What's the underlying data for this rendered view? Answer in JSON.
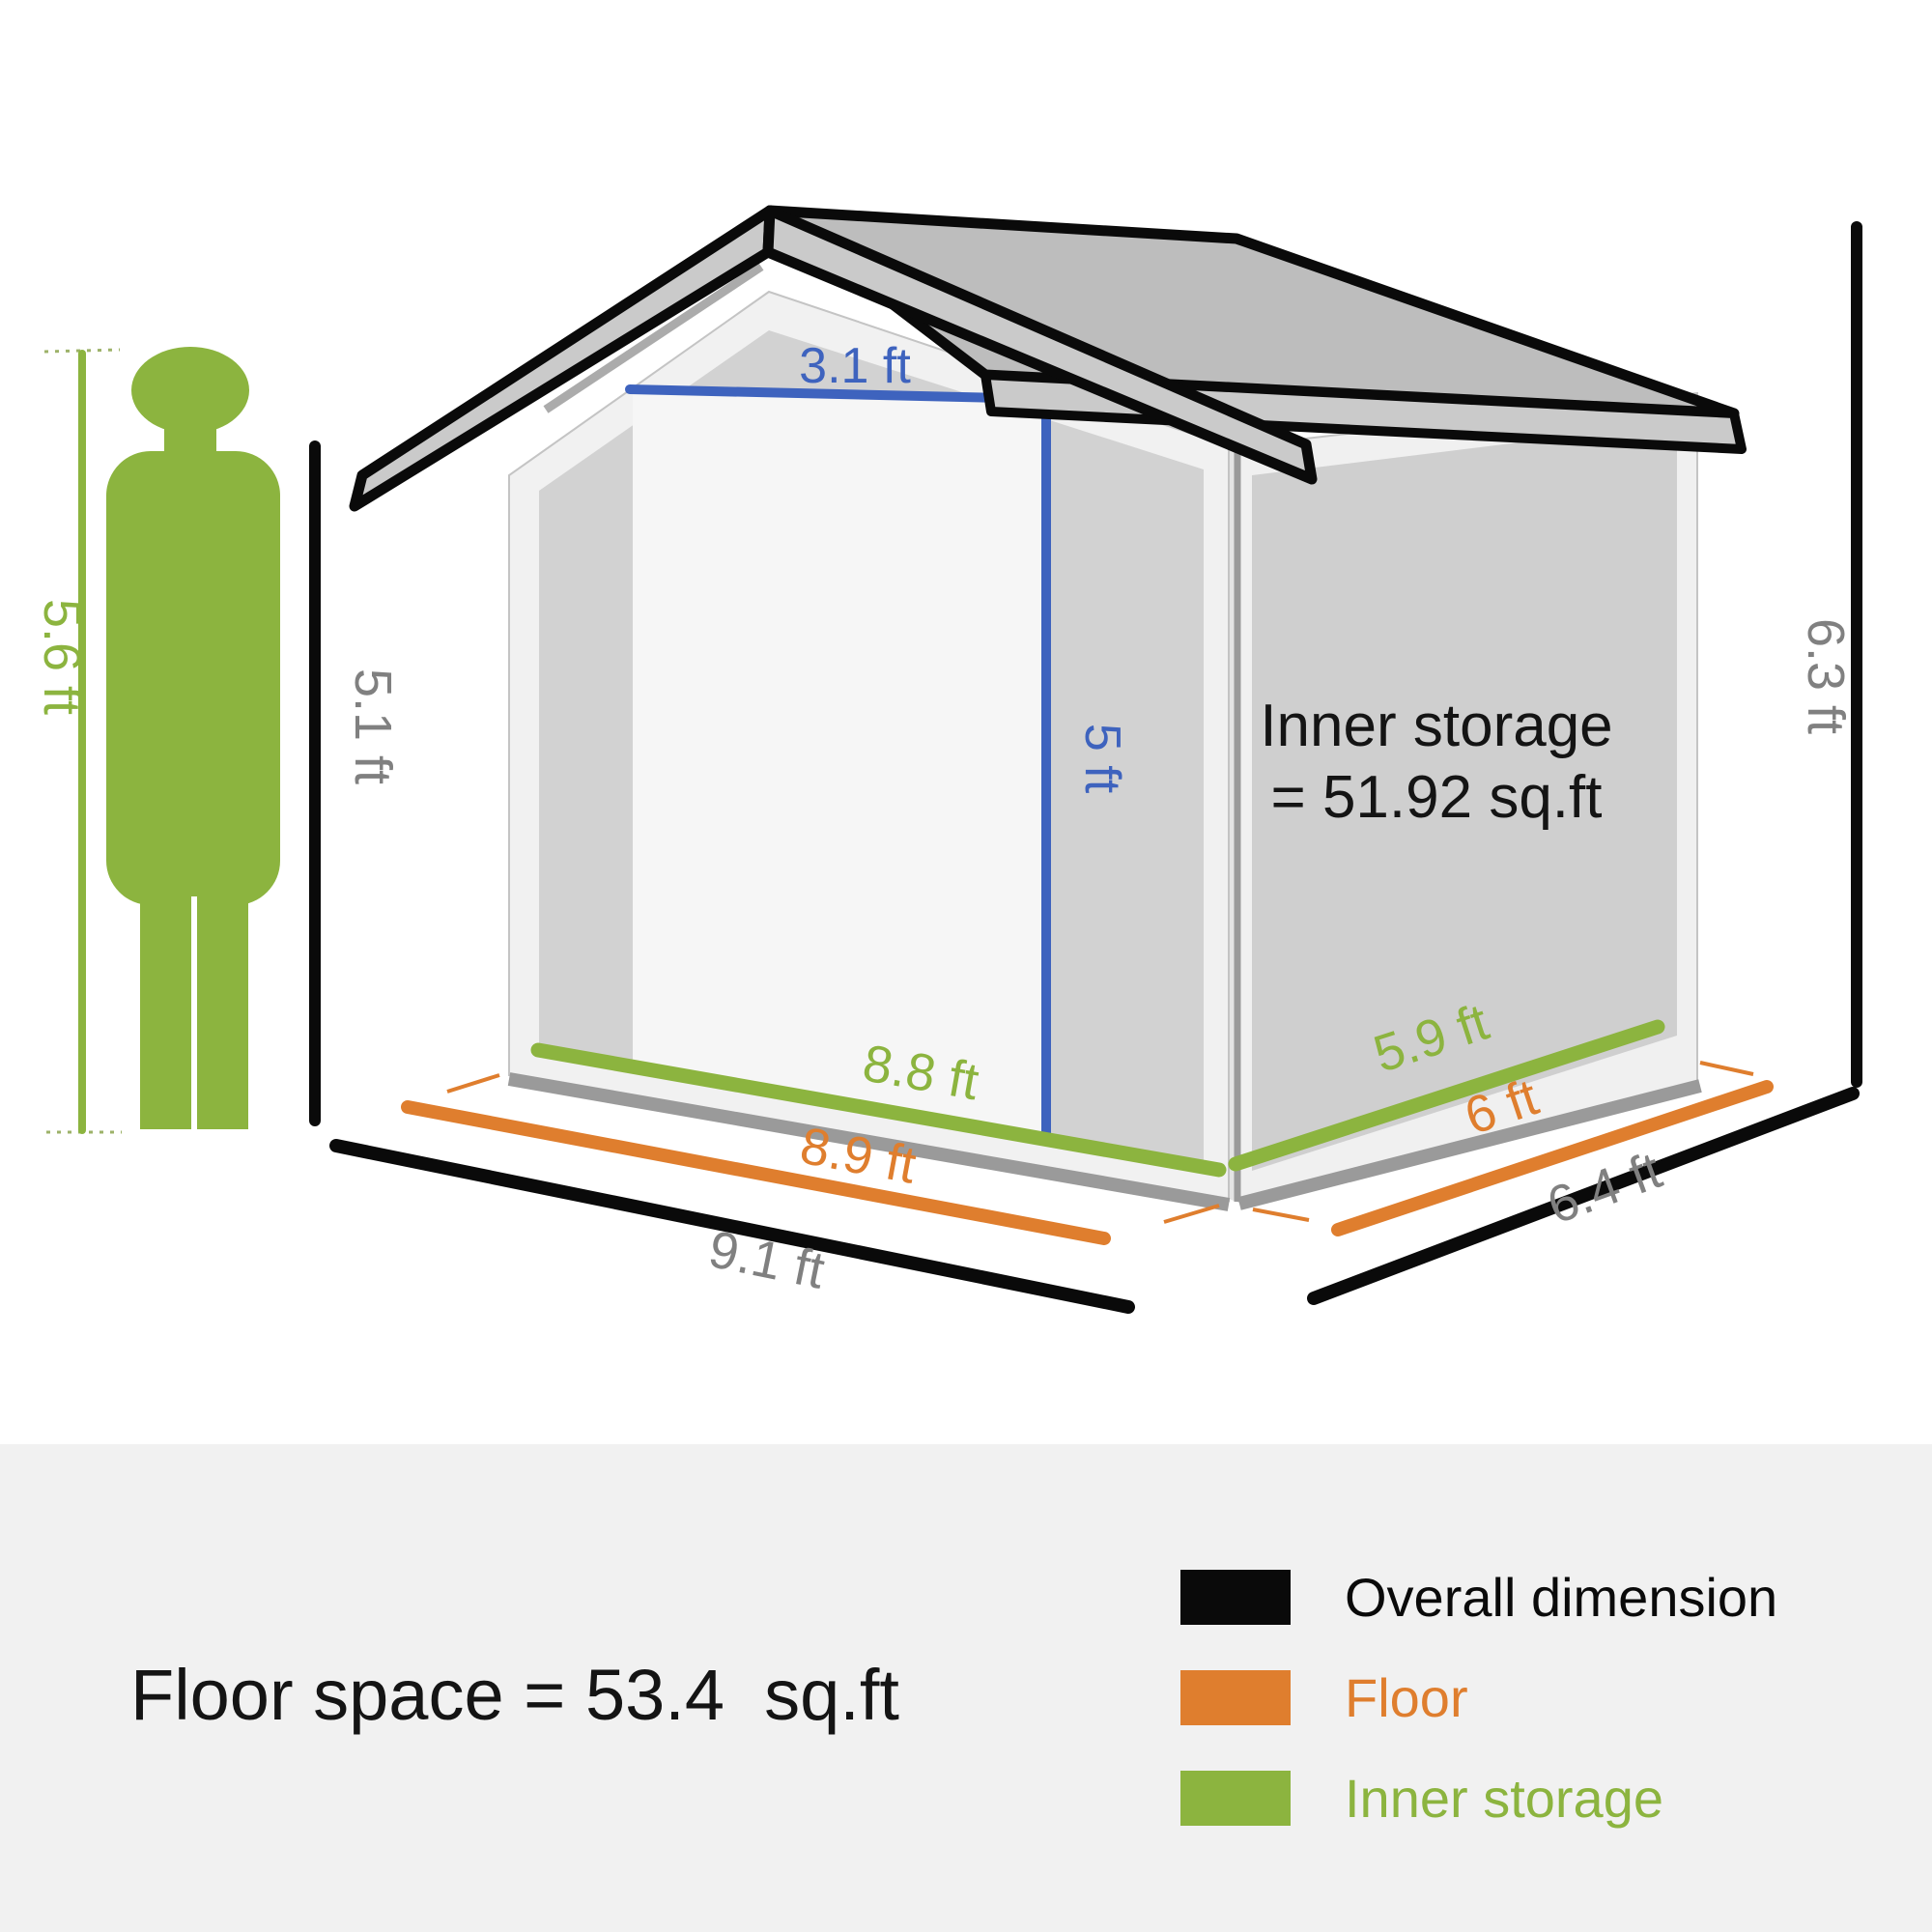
{
  "figure": {
    "height_label": "5.6 ft"
  },
  "dimensions": {
    "shed_front_height": "5.1 ft",
    "shed_overall_height": "6.3 ft",
    "door_width": "3.1 ft",
    "door_height": "5 ft",
    "inner_width": "8.8 ft",
    "floor_width": "8.9 ft",
    "overall_width": "9.1 ft",
    "inner_depth": "5.9 ft",
    "floor_depth": "6 ft",
    "overall_depth": "6.4 ft"
  },
  "shed": {
    "inner_storage_line1": "Inner storage",
    "inner_storage_line2": "= 51.92 sq.ft"
  },
  "footer": {
    "floor_space": "Floor space = 53.4  sq.ft",
    "legend": [
      {
        "label": "Overall dimension",
        "color": "#0a0a0a"
      },
      {
        "label": "Floor",
        "color": "#df7e2e"
      },
      {
        "label": "Inner storage",
        "color": "#8cb43f"
      }
    ]
  },
  "colors": {
    "accent_green": "#8cb43f",
    "accent_orange": "#df7e2e",
    "accent_blue": "#3e63be",
    "dimension_gray": "#808080",
    "line_black": "#0a0a0a"
  }
}
